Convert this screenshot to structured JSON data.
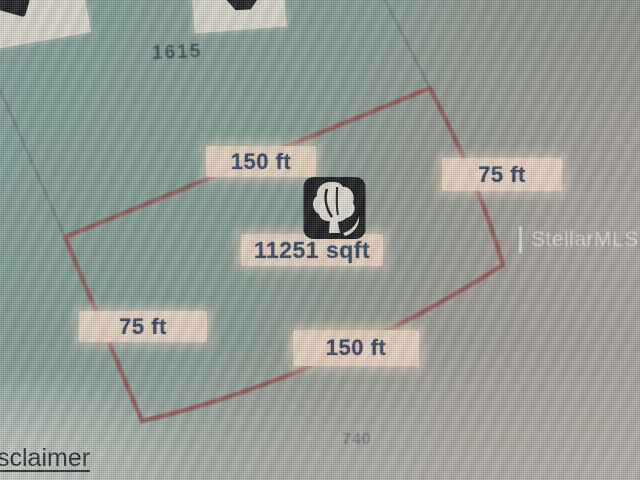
{
  "map": {
    "lot_number_top": "1615",
    "lot_number_bottom": "740",
    "watermark_text": "StellarMLS",
    "disclaimer_link_partial": "sclaimer",
    "parcel": {
      "area": "11251 sqft",
      "dim_top": "150 ft",
      "dim_right": "75 ft",
      "dim_left": "75 ft",
      "dim_bottom": "150 ft",
      "marker_icon": "tree-icon"
    }
  },
  "theme": {
    "parcel-line": "#8d4b49",
    "neighbor-line": "#546066",
    "band-bg": "rgba(236,211,191,0.92)",
    "band-glow": "rgba(232,206,188,0.55)",
    "dim-text": "#2e3e5c",
    "lot-text": "#39464e",
    "lot-faint": "#5a6579",
    "cutbox-bg": "#d6d2c5",
    "icon-bg": "#101113",
    "icon-glyph": "#dbd8cd",
    "watermark": "rgba(255,255,255,0.55)",
    "link-text": "#232328",
    "map-teal": "#7c9a94",
    "map-gray": "#a5a09b"
  }
}
